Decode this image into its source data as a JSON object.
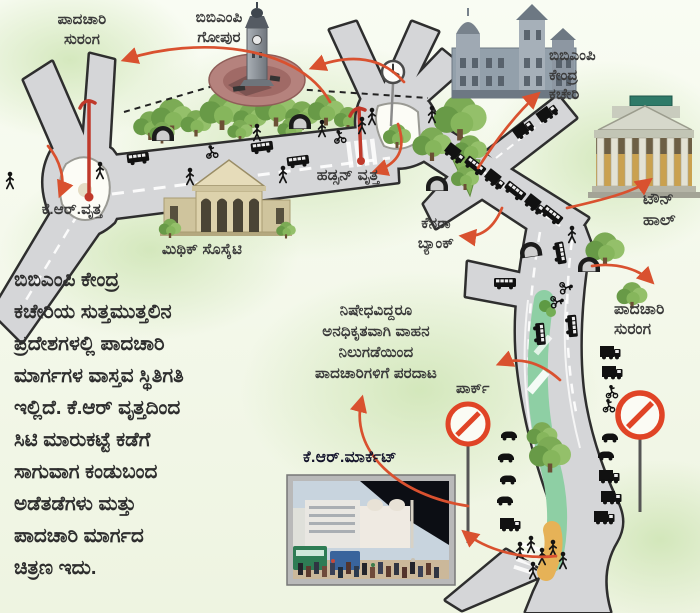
{
  "intro": {
    "text": "ಬಿಬಿಎಂಪಿ ಕೇಂದ್ರ\nಕಚೇರಿಯ ಸುತ್ತಮುತ್ತಲಿನ\nಪ್ರದೇಶಗಳಲ್ಲಿ ಪಾದಚಾರಿ\nಮಾರ್ಗಗಳ ವಾಸ್ತವ ಸ್ಥಿತಿಗತಿ\nಇಲ್ಲಿದೆ. ಕೆ.ಆರ್ ವೃತ್ತದಿಂದ\nಸಿಟಿ ಮಾರುಕಟ್ಟೆ ಕಡೆಗೆ\nಸಾಗುವಾಗ ಕಂಡುಬಂದ\nಅಡೆತಡೆಗಳು ಮತ್ತು\nಪಾದಚಾರಿ ಮಾರ್ಗದ\nಚಿತ್ರಣ ಇದು."
  },
  "map_labels": {
    "pedestrian_tunnel_left": "ಪಾದಚಾರಿ\nಸುರಂಗ",
    "bbmp_tower": "ಬಿಬಿಎಂಪಿ\nಗೋಪುರ",
    "bbmp_head_office": "ಬಿಬಿಎಂಪಿ\nಕೇಂದ್ರ\nಕಚೇರಿ",
    "town_hall": "ಟೌನ್\nಹಾಲ್",
    "kr_circle": "ಕೆ.ಆರ್.ವೃತ್ತ",
    "mythic_society": "ಮಿಥಿಕ್ ಸೊಸೈಟಿ",
    "hudson_circle": "ಹಡ್ಸನ್ ವೃತ್ತ",
    "canara_bank": "ಕೆನರಾ\nಬ್ಯಾಂಕ್",
    "pedestrian_tunnel_right": "ಪಾದಚಾರಿ\nಸುರಂಗ",
    "parking_note": "ನಿಷೇಧವಿದ್ದರೂ\nಅನಧಿಕೃತವಾಗಿ ವಾಹನ\nನಿಲುಗಡೆಯಿಂದ\nಪಾದಚಾರಿಗಳಿಗೆ ಪರದಾಟ",
    "park": "ಪಾರ್ಕ್",
    "kr_market": "ಕೆ.ಆರ್.ಮಾರ್ಕೆಟ್"
  },
  "colors": {
    "arrow": "#d9512f",
    "road_fill": "#d5d6d8",
    "road_outline": "#2e2e2e",
    "no_parking_sign": "#e04426",
    "median_green": "#8ecfa4",
    "tree_green": "#7cab55",
    "label_text": "#3b3b3b"
  }
}
